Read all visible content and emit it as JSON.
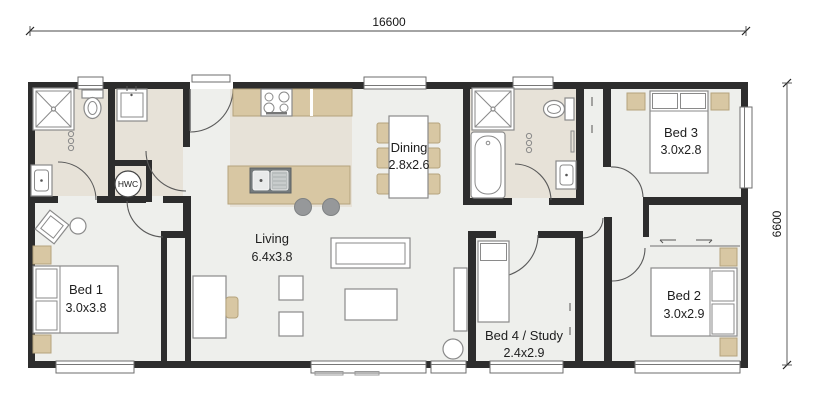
{
  "drawing": {
    "width_dimension": "16600",
    "height_dimension": "6600"
  },
  "rooms": {
    "living": {
      "name": "Living",
      "size": "6.4x3.8"
    },
    "dining": {
      "name": "Dining",
      "size": "2.8x2.6"
    },
    "bed1": {
      "name": "Bed 1",
      "size": "3.0x3.8"
    },
    "bed2": {
      "name": "Bed 2",
      "size": "3.0x2.9"
    },
    "bed3": {
      "name": "Bed 3",
      "size": "3.0x2.8"
    },
    "bed4": {
      "name": "Bed 4 / Study",
      "size": "2.4x2.9"
    }
  },
  "labels": {
    "hot_water_cylinder": "HWC"
  },
  "colors": {
    "wall": "#2d2d2d",
    "floor": "#eeefec",
    "wet_area_floor": "#e7e2d8",
    "timber": "#d8c7a3",
    "stool_gray": "#96989a"
  }
}
